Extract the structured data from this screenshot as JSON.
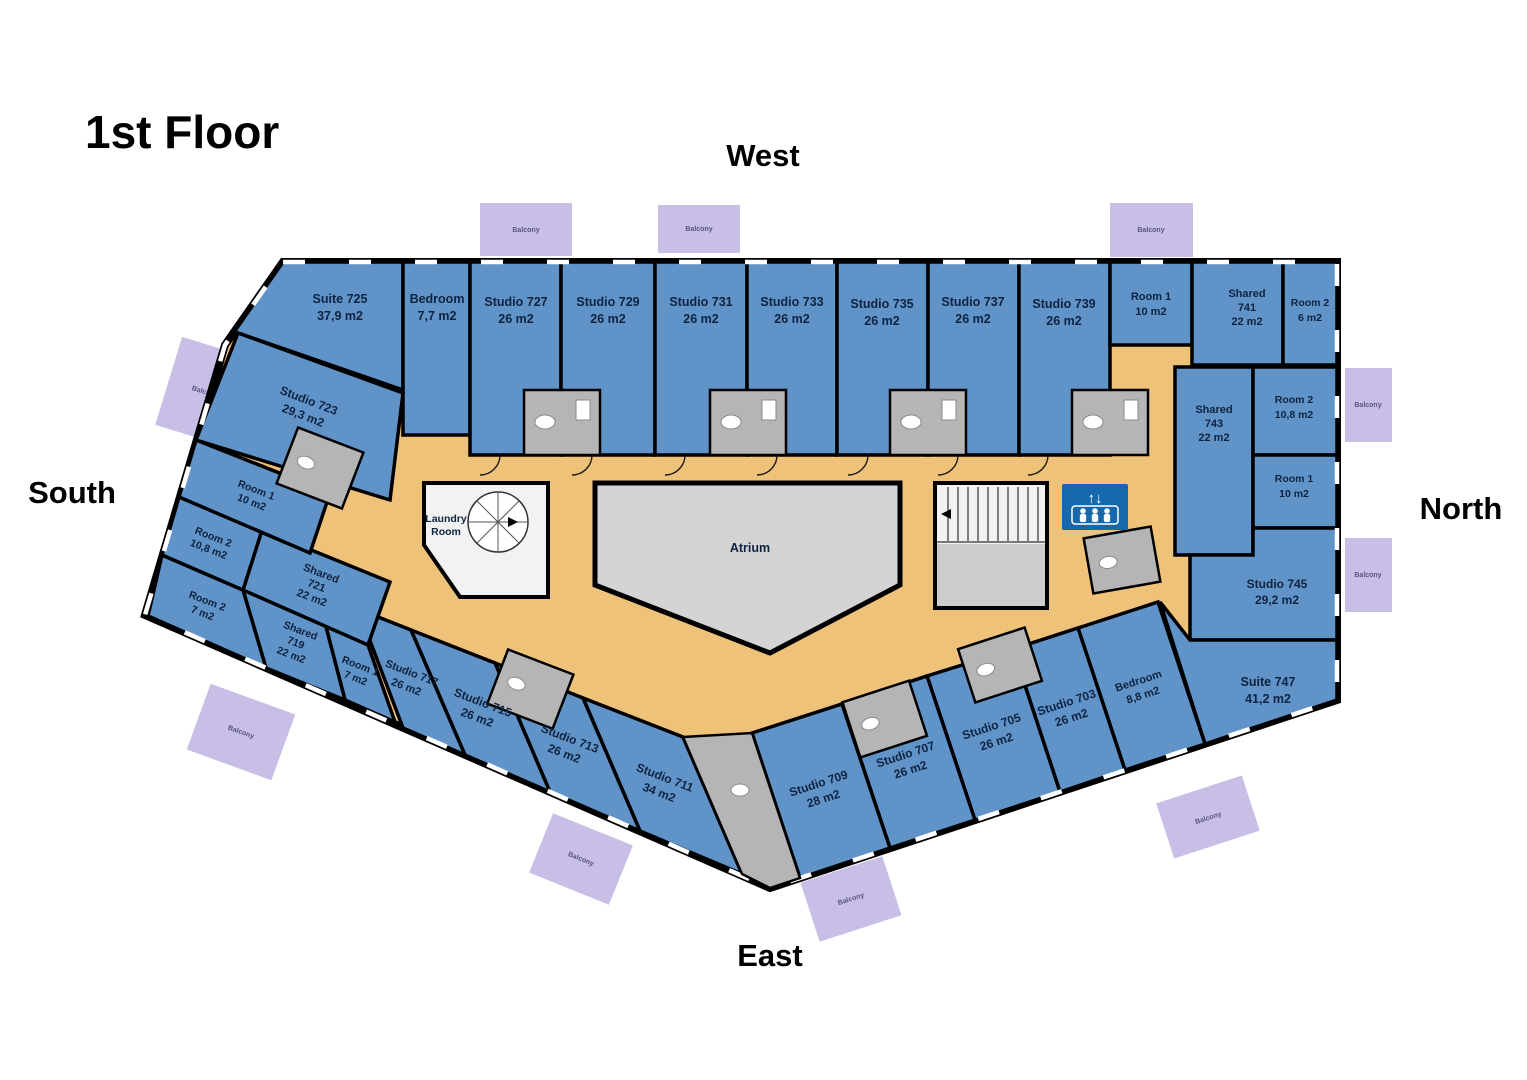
{
  "title": "1st Floor",
  "compass": {
    "west": "West",
    "south": "South",
    "north": "North",
    "east": "East"
  },
  "atrium_label": "Atrium",
  "laundry_label_1": "Laundry",
  "laundry_label_2": "Room",
  "balcony_label": "Balcony",
  "icons": {
    "elevator": "elevator-up-down-people-icon",
    "elevator_arrows": "↑↓",
    "stairs": "u-shaped-staircase",
    "spiral_stairs": "spiral-staircase"
  },
  "colors": {
    "room": "#6093C8",
    "corridor": "#EFC279",
    "atrium": "#D4D4D4",
    "balcony": "#C8BEE6",
    "elevator": "#1668AC",
    "wall": "#000000"
  },
  "rooms": [
    {
      "id": "suite-725",
      "name": "Suite 725",
      "area": "37,9 m2"
    },
    {
      "id": "bedroom-725",
      "name": "Bedroom",
      "area": "7,7 m2"
    },
    {
      "id": "studio-727",
      "name": "Studio 727",
      "area": "26 m2"
    },
    {
      "id": "studio-729",
      "name": "Studio 729",
      "area": "26 m2"
    },
    {
      "id": "studio-731",
      "name": "Studio 731",
      "area": "26 m2"
    },
    {
      "id": "studio-733",
      "name": "Studio 733",
      "area": "26 m2"
    },
    {
      "id": "studio-735",
      "name": "Studio 735",
      "area": "26 m2"
    },
    {
      "id": "studio-737",
      "name": "Studio 737",
      "area": "26 m2"
    },
    {
      "id": "studio-739",
      "name": "Studio 739",
      "area": "26 m2"
    },
    {
      "id": "room1-741",
      "name": "Room 1",
      "area": "10 m2"
    },
    {
      "id": "shared-741",
      "name": "Shared",
      "num": "741",
      "area": "22 m2"
    },
    {
      "id": "room2-741",
      "name": "Room 2",
      "area": "6 m2"
    },
    {
      "id": "shared-743",
      "name": "Shared",
      "num": "743",
      "area": "22 m2"
    },
    {
      "id": "room2-743",
      "name": "Room 2",
      "area": "10,8 m2"
    },
    {
      "id": "room1-743",
      "name": "Room 1",
      "area": "10 m2"
    },
    {
      "id": "studio-745",
      "name": "Studio 745",
      "area": "29,2 m2"
    },
    {
      "id": "suite-747",
      "name": "Suite 747",
      "area": "41,2 m2"
    },
    {
      "id": "bedroom-747",
      "name": "Bedroom",
      "area": "8,8 m2"
    },
    {
      "id": "studio-703",
      "name": "Studio 703",
      "area": "26 m2"
    },
    {
      "id": "studio-705",
      "name": "Studio 705",
      "area": "26 m2"
    },
    {
      "id": "studio-707",
      "name": "Studio 707",
      "area": "26 m2"
    },
    {
      "id": "studio-709",
      "name": "Studio 709",
      "area": "28 m2"
    },
    {
      "id": "studio-711",
      "name": "Studio 711",
      "area": "34 m2"
    },
    {
      "id": "studio-713",
      "name": "Studio 713",
      "area": "26 m2"
    },
    {
      "id": "studio-715",
      "name": "Studio 715",
      "area": "26 m2"
    },
    {
      "id": "studio-717",
      "name": "Studio 717",
      "area": "26 m2"
    },
    {
      "id": "room1-719",
      "name": "Room 1",
      "area": "7 m2"
    },
    {
      "id": "shared-719",
      "name": "Shared",
      "num": "719",
      "area": "22 m2"
    },
    {
      "id": "room2-719",
      "name": "Room 2",
      "area": "7 m2"
    },
    {
      "id": "shared-721",
      "name": "Shared",
      "num": "721",
      "area": "22 m2"
    },
    {
      "id": "room2-721",
      "name": "Room 2",
      "area": "10,8 m2"
    },
    {
      "id": "room1-721",
      "name": "Room 1",
      "area": "10 m2"
    },
    {
      "id": "studio-723",
      "name": "Studio 723",
      "area": "29,3 m2"
    }
  ]
}
